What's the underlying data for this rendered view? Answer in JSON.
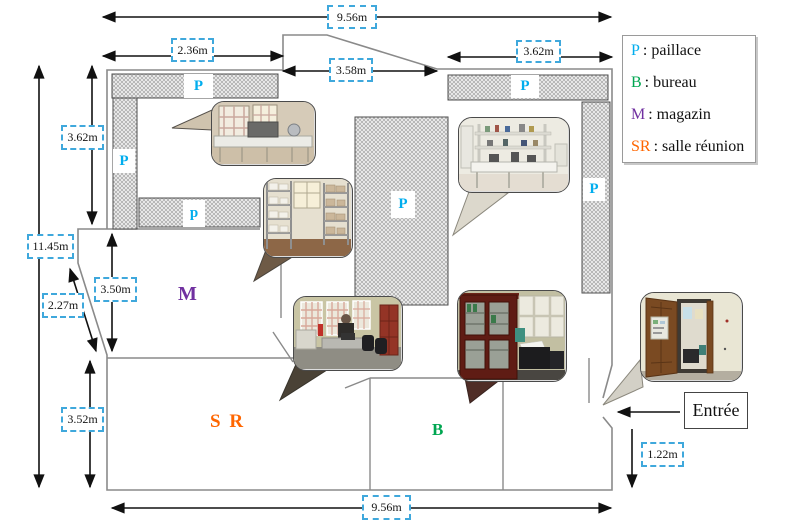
{
  "plan": {
    "dimensions": {
      "top_width": "9.56m",
      "top_left_width": "2.36m",
      "top_mid_width": "3.58m",
      "top_right_width": "3.62m",
      "left_upper_height": "3.62m",
      "left_total_height": "11.45m",
      "magazin_height": "3.50m",
      "diagonal_wall": "2.27m",
      "salle_reunion_height": "3.52m",
      "bottom_width": "9.56m",
      "entrance_offset": "1.22m"
    },
    "bench_marks": {
      "top_left": "P",
      "left": "P",
      "middle": "p",
      "central": "P",
      "top_right": "P",
      "right": "P"
    },
    "room_labels": {
      "magazin": "M",
      "salle_reunion": "S R",
      "bureau": "B"
    },
    "entrance_label": "Entrée"
  },
  "legend": {
    "items": [
      {
        "symbol": "P",
        "text": ": paillace",
        "color": "#00adee"
      },
      {
        "symbol": "B",
        "text": ": bureau",
        "color": "#00a651"
      },
      {
        "symbol": "M",
        "text": ":  magazin",
        "color": "#7030a0"
      },
      {
        "symbol": "SR",
        "text": ": salle réunion",
        "color": "#ff6600"
      }
    ]
  },
  "colors": {
    "paillasse_letter": "#00adee",
    "bureau_letter": "#00a651",
    "magazin_letter": "#7030a0",
    "salle_reunion_letter": "#ff6600",
    "dimension_box_border": "#3fa8dc",
    "wall_line": "#8a8a8a",
    "arrow": "#111111"
  }
}
